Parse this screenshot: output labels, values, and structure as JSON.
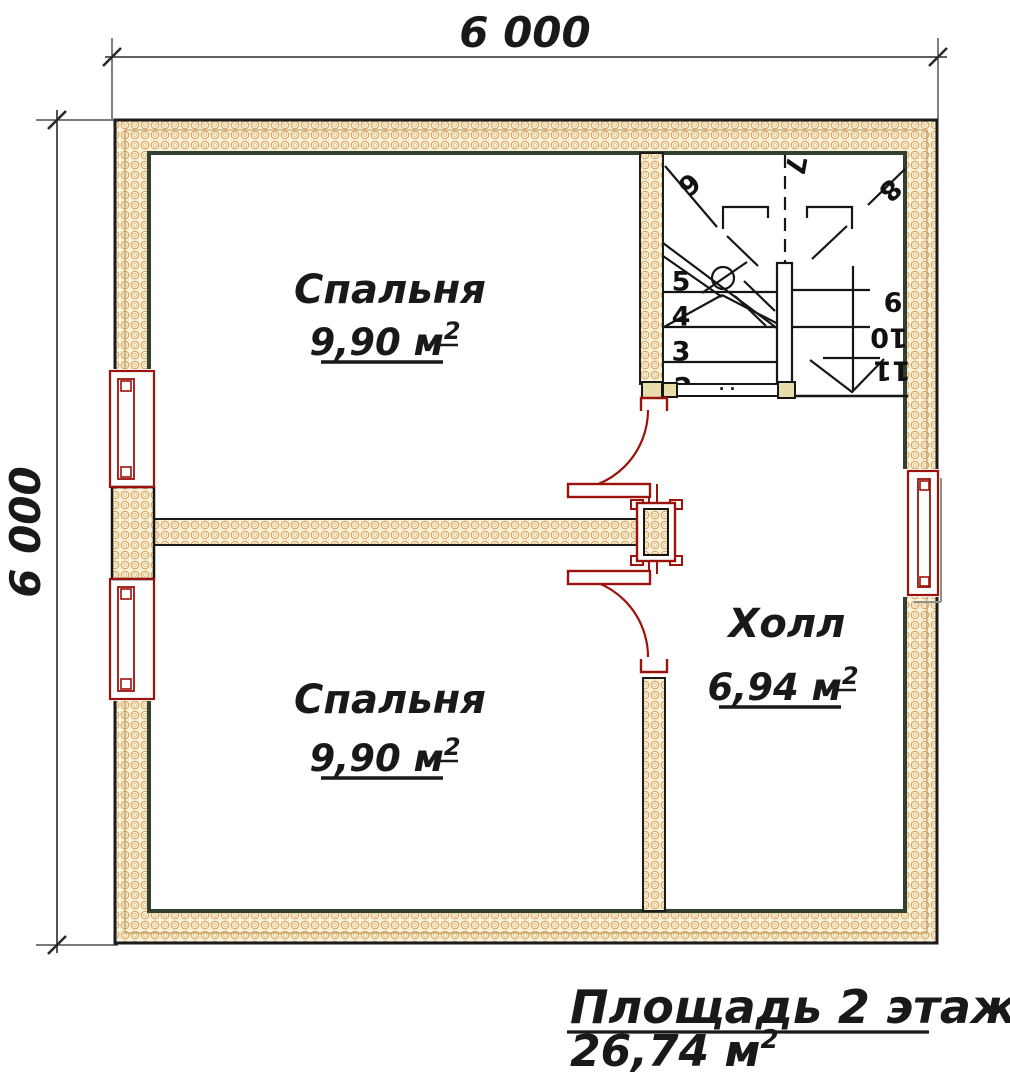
{
  "plan": {
    "dimensions": {
      "top": "6 000",
      "left": "6 000"
    },
    "rooms": {
      "bedroom_top": {
        "name": "Спальня",
        "area": "9,90 м",
        "area_sup": "2"
      },
      "bedroom_bottom": {
        "name": "Спальня",
        "area": "9,90 м",
        "area_sup": "2"
      },
      "hall": {
        "name": "Холл",
        "area": "6,94 м",
        "area_sup": "2"
      }
    },
    "stairs": {
      "steps": {
        "s2": "2",
        "s3": "3",
        "s4": "4",
        "s5": "5",
        "s6": "6",
        "s7": "7",
        "s8": "8",
        "s9": "9",
        "s10": "10",
        "s11": "11"
      },
      "rail_dots": "· ·"
    },
    "footer": {
      "title": "Площадь 2 этажа:",
      "value": "26,74 м",
      "value_sup": "2"
    },
    "colors": {
      "wall_outline": "#1c1c1c",
      "wall_inner_line": "#32402f",
      "wall_fill": "#f8f1da",
      "hatch": "#d99c54",
      "joinery_red": "#9b130c",
      "text": "#191919"
    }
  }
}
